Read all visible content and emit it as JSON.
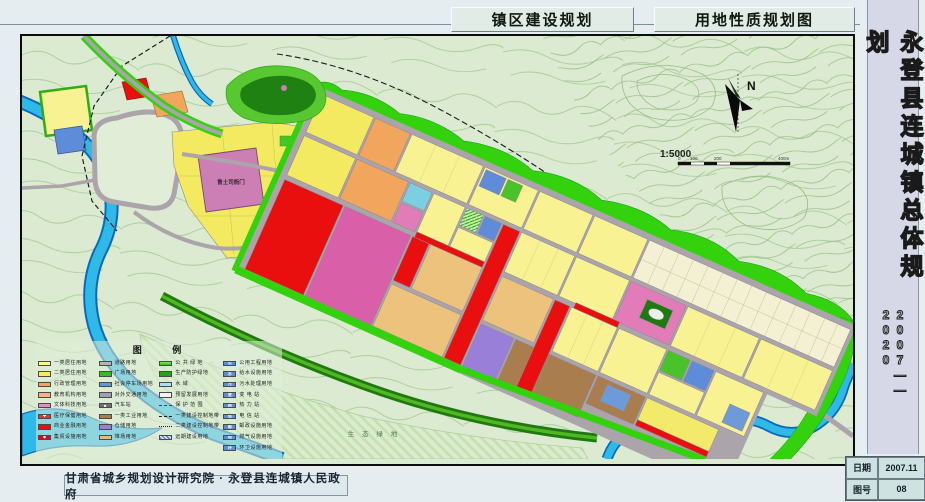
{
  "header": {
    "title_left": "镇区建设规划",
    "title_right": "用地性质规划图"
  },
  "sidebar": {
    "title": "永登县连城镇总体规划",
    "period": "2007——2020"
  },
  "footer": {
    "credit": "甘肃省城乡规划设计研究院 · 永登县连城镇人民政府",
    "date_label": "日期",
    "date_value": "2007.11",
    "sheet_label": "图号",
    "sheet_value": "08"
  },
  "map": {
    "labels": {
      "historic_site": "鲁土司衙门",
      "eco_green": "生 态 绿 地"
    },
    "compass": {
      "north": "N"
    },
    "scale": {
      "ratio": "1:5000",
      "ticks": [
        "0",
        "100",
        "200",
        "400m"
      ]
    }
  },
  "legend": {
    "title": "图    例",
    "columns": [
      {
        "items": [
          {
            "label": "一类居住用地",
            "type": "solid",
            "color": "#f9f598"
          },
          {
            "label": "二类居住用地",
            "type": "solid",
            "color": "#f3ea62"
          },
          {
            "label": "行政管理用地",
            "type": "solid",
            "color": "#f2a55c"
          },
          {
            "label": "教育机构用地",
            "type": "solid",
            "color": "#f5b285"
          },
          {
            "label": "文体科技用地",
            "type": "solid",
            "color": "#e58cc2"
          },
          {
            "label": "医疗保健用地",
            "type": "solid",
            "color": "#e93038",
            "icon": "✚"
          },
          {
            "label": "商业金融用地",
            "type": "solid",
            "color": "#e90f0f"
          },
          {
            "label": "集贸设施用地",
            "type": "solid",
            "color": "#d40f0f",
            "icon": "◆"
          }
        ]
      },
      {
        "items": [
          {
            "label": "道路用地",
            "type": "solid",
            "color": "#b3b3b3"
          },
          {
            "label": "广场用地",
            "type": "solid",
            "color": "#2fc01e"
          },
          {
            "label": "社会停车场用地",
            "type": "solid",
            "color": "#5f9ad8"
          },
          {
            "label": "对外交通用地",
            "type": "solid",
            "color": "#9aa3ad"
          },
          {
            "label": "汽车站",
            "type": "solid",
            "color": "#6f6f77",
            "icon": "■"
          },
          {
            "label": "一类工业用地",
            "type": "solid",
            "color": "#a97d4d"
          },
          {
            "label": "仓储用地",
            "type": "solid",
            "color": "#9a7fd8"
          },
          {
            "label": "堆场用地",
            "type": "solid",
            "color": "#e3bd7c"
          }
        ]
      },
      {
        "items": [
          {
            "label": "公 共 绿 地",
            "type": "gradient-green"
          },
          {
            "label": "生产防护绿地",
            "type": "solid",
            "color": "#1fa317"
          },
          {
            "label": "水  域",
            "type": "water"
          },
          {
            "label": "预留发展用地",
            "type": "outline"
          },
          {
            "label": "保 护 范 围",
            "type": "line-red"
          },
          {
            "label": "一类建设控制地带",
            "type": "line-dash"
          },
          {
            "label": "二类建设控制地带",
            "type": "line-dashdot"
          },
          {
            "label": "远期建设用地",
            "type": "hatch-blue"
          }
        ]
      },
      {
        "items": [
          {
            "label": "公用工程用地",
            "type": "solid",
            "color": "#5f8cd8",
            "icon": "公"
          },
          {
            "label": "给水设施用地",
            "type": "solid",
            "color": "#5f8cd8",
            "icon": "水"
          },
          {
            "label": "污水处理用地",
            "type": "solid",
            "color": "#5f8cd8",
            "icon": "污"
          },
          {
            "label": "变 电 站",
            "type": "solid",
            "color": "#5f8cd8",
            "icon": "变"
          },
          {
            "label": "热 力 站",
            "type": "solid",
            "color": "#5f8cd8",
            "icon": "热"
          },
          {
            "label": "电 信 站",
            "type": "solid",
            "color": "#5f8cd8",
            "icon": "信"
          },
          {
            "label": "邮政设施用地",
            "type": "solid",
            "color": "#5f8cd8",
            "icon": "邮"
          },
          {
            "label": "燃气设施用地",
            "type": "solid",
            "color": "#5f8cd8",
            "icon": "燃"
          },
          {
            "label": "环卫设施用地",
            "type": "solid",
            "color": "#5f8cd8",
            "icon": "环"
          }
        ]
      }
    ]
  },
  "colors": {
    "page_bg": "#e5edf0",
    "map_bg": "#dcead2",
    "river": "#2fb9e9",
    "protective_green": "#33d20d",
    "road_gray": "#aba4ab",
    "commercial_red": "#e90f0f",
    "residential_yellow": "#f3ea62",
    "market_magenta": "#d95fa8"
  }
}
